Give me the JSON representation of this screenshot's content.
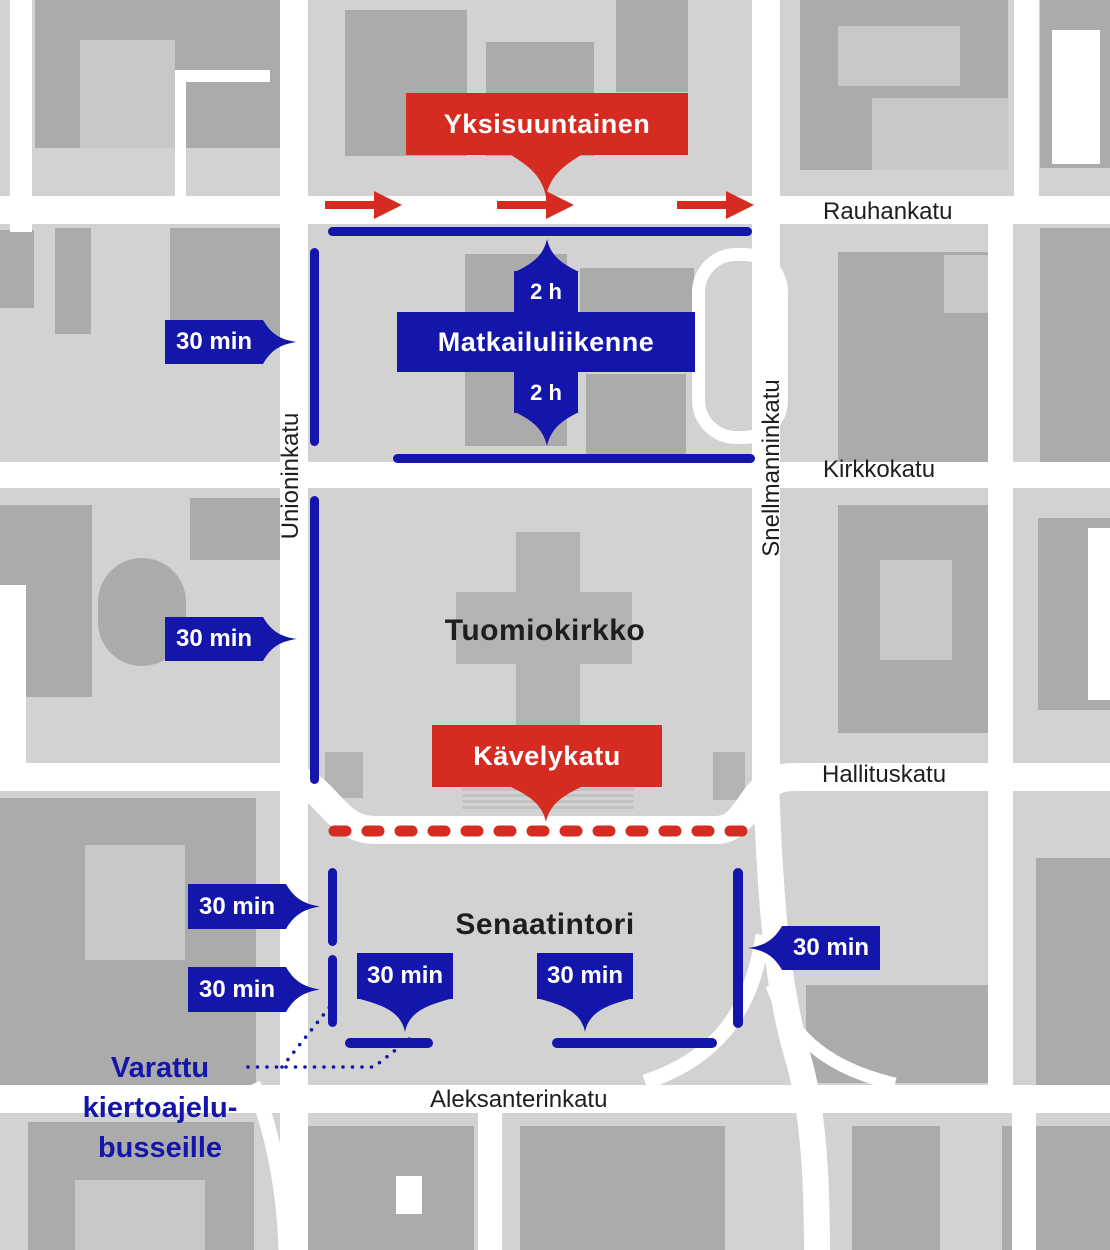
{
  "title": "Senaatintori parking and traffic map",
  "colors": {
    "red": "#d62b20",
    "blue": "#1415aa",
    "background": "#d2d2d2",
    "building": "#ababab",
    "building_light": "#c7c7c7",
    "street": "#ffffff",
    "label": "#1e1e1c"
  },
  "banners": {
    "one_way": {
      "label": "Yksisuuntainen"
    },
    "tourist_traffic": {
      "label": "Matkailuliikenne",
      "tab_top": "2 h",
      "tab_bottom": "2 h"
    },
    "pedestrian_street": {
      "label": "Kävelykatu"
    }
  },
  "streets": {
    "rauhankatu": "Rauhankatu",
    "kirkkokatu": "Kirkkokatu",
    "hallituskatu": "Hallituskatu",
    "aleksanterinkatu": "Aleksanterinkatu",
    "unioninkatu": "Unioninkatu",
    "snellmanninkatu": "Snellmanninkatu"
  },
  "places": {
    "cathedral": "Tuomiokirkko",
    "square": "Senaatintori"
  },
  "parking_badges": {
    "unioninkatu_upper": "30 min",
    "unioninkatu_lower": "30 min",
    "square_west_upper": "30 min",
    "square_west_lower": "30 min",
    "square_south_left": "30 min",
    "square_south_right": "30 min",
    "square_east": "30 min"
  },
  "note_reserved_buses": {
    "lines": [
      "Varattu",
      "kiertoajelu-",
      "busseille"
    ]
  }
}
